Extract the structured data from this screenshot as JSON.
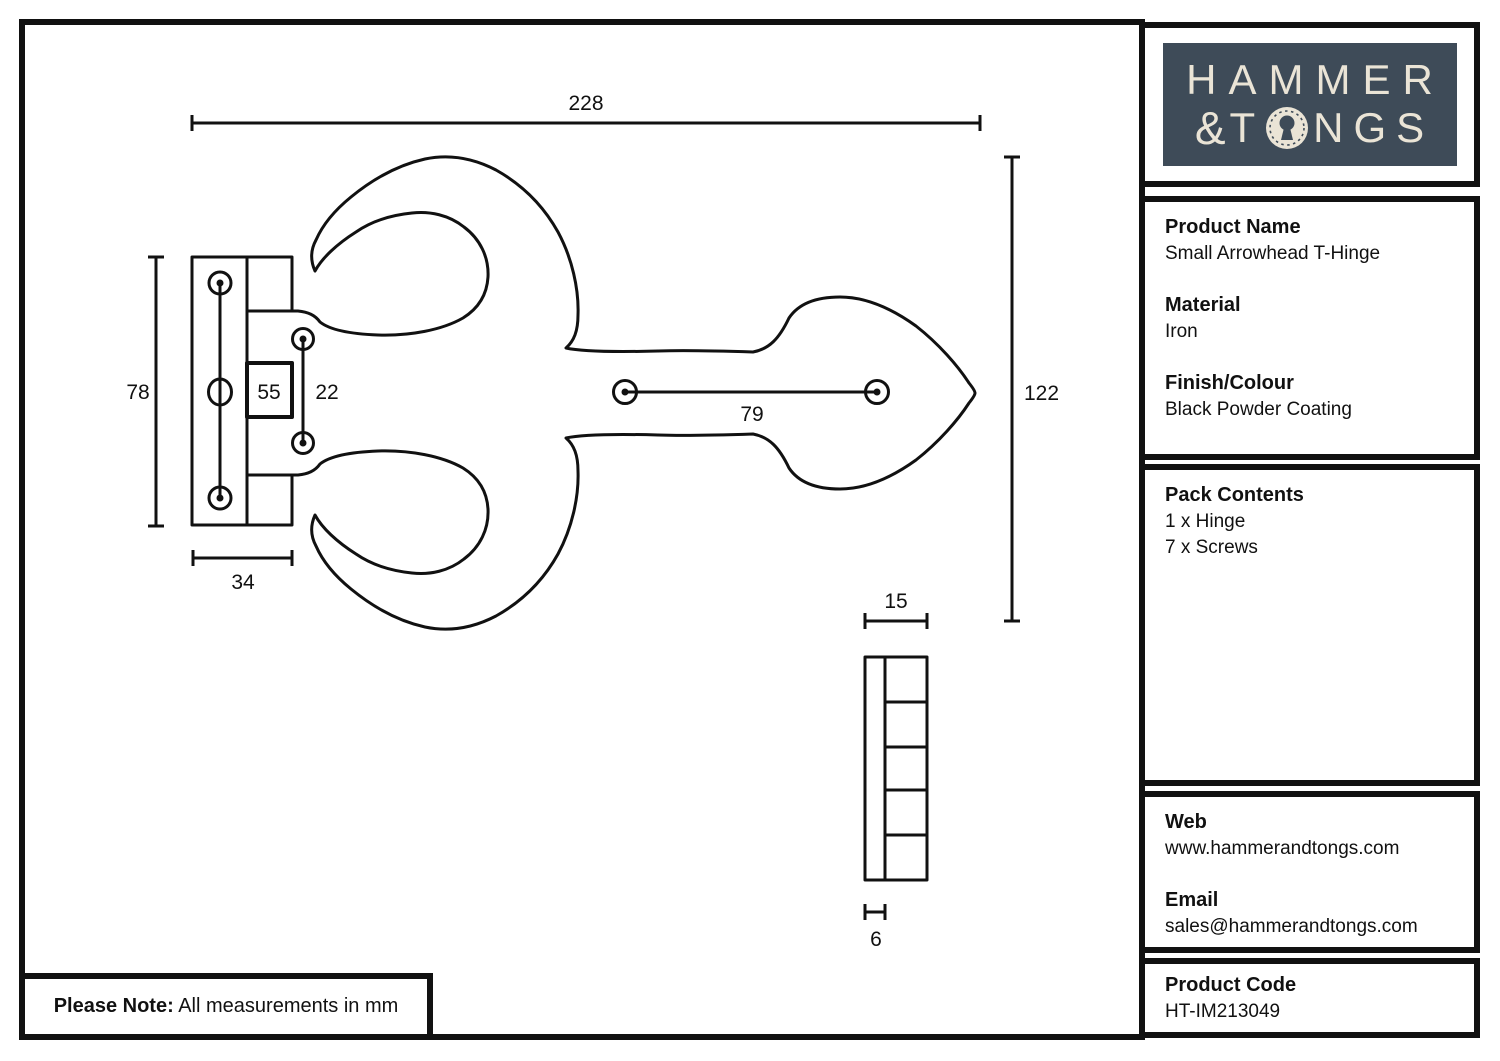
{
  "colors": {
    "line": "#111111",
    "logo_bg": "#3e4b58",
    "logo_fg": "#eae4d6"
  },
  "logo": {
    "line1": "HAMMER",
    "amp": "&",
    "t": "T",
    "rest": "NGS",
    "keyhole_icon": "keyhole"
  },
  "sidebar": {
    "product": {
      "name_label": "Product Name",
      "name_value": "Small Arrowhead T-Hinge",
      "material_label": "Material",
      "material_value": "Iron",
      "finish_label": "Finish/Colour",
      "finish_value": "Black Powder Coating"
    },
    "pack": {
      "title": "Pack Contents",
      "item1": "1 x Hinge",
      "item2": "7 x Screws"
    },
    "contact": {
      "web_label": "Web",
      "web_value": "www.hammerandtongs.com",
      "email_label": "Email",
      "email_value": "sales@hammerandtongs.com"
    },
    "code": {
      "label": "Product Code",
      "value": "HT-IM213049"
    }
  },
  "note": {
    "label": "Please Note:",
    "text": " All measurements in mm"
  },
  "drawing": {
    "dims": {
      "total_width": "228",
      "right_height": "122",
      "plate_height": "78",
      "plate_width": "34",
      "knuckle": "55",
      "arm_screw_gap": "22",
      "strap_screw_gap": "79",
      "side_width": "15",
      "side_thickness": "6"
    }
  }
}
